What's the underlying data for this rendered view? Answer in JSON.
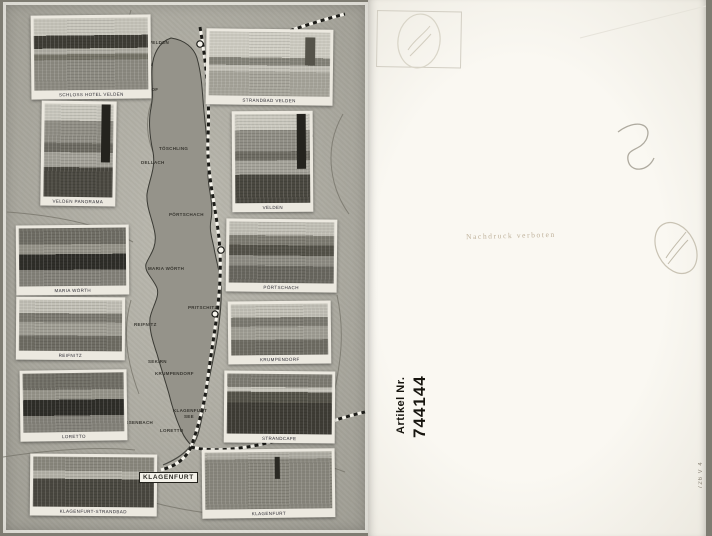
{
  "postcard": {
    "type": "scanned vintage postcard, front (Wörthersee pictorial map) and back",
    "colors": {
      "front_paper": "#b4b2a7",
      "lake_fill": "#95938a",
      "back_paper": "#f7f5ee",
      "artikel_text": "#17150f",
      "faint_stamp": "#c7c1b2"
    },
    "front": {
      "photos": [
        {
          "caption": "SCHLOSS HOTEL VELDEN",
          "variant": "v-hotel",
          "x": 28,
          "y": 13,
          "w": 120,
          "h": 84,
          "tilt": -0.6
        },
        {
          "caption": "VELDEN PANORAMA",
          "variant": "v-mtn",
          "x": 38,
          "y": 99,
          "w": 75,
          "h": 105,
          "tilt": 0.8
        },
        {
          "caption": "MARIA WÖRTH",
          "variant": "v-island",
          "x": 13,
          "y": 223,
          "w": 113,
          "h": 70,
          "tilt": -0.5
        },
        {
          "caption": "REIFNITZ",
          "variant": "v-village",
          "x": 13,
          "y": 295,
          "w": 109,
          "h": 63,
          "tilt": 0.4
        },
        {
          "caption": "LORETTO",
          "variant": "v-island",
          "x": 17,
          "y": 368,
          "w": 107,
          "h": 71,
          "tilt": -0.8
        },
        {
          "caption": "KLAGENFURT-STRANDBAD",
          "variant": "v-forest",
          "x": 27,
          "y": 452,
          "w": 127,
          "h": 62,
          "tilt": 0.5
        },
        {
          "caption": "STRANDBAD VELDEN",
          "variant": "v-beach",
          "x": 203,
          "y": 27,
          "w": 127,
          "h": 76,
          "tilt": 0.7
        },
        {
          "caption": "VELDEN",
          "variant": "v-mtn",
          "x": 229,
          "y": 109,
          "w": 81,
          "h": 101,
          "tilt": -0.4
        },
        {
          "caption": "PÖRTSCHACH",
          "variant": "v-pan",
          "x": 223,
          "y": 217,
          "w": 111,
          "h": 73,
          "tilt": 0.6
        },
        {
          "caption": "KRUMPENDORF",
          "variant": "v-village",
          "x": 225,
          "y": 299,
          "w": 103,
          "h": 63,
          "tilt": -0.6
        },
        {
          "caption": "STRANDCAFE",
          "variant": "v-darklake",
          "x": 221,
          "y": 369,
          "w": 111,
          "h": 72,
          "tilt": 0.5
        },
        {
          "caption": "KLAGENFURT",
          "variant": "v-town",
          "x": 199,
          "y": 447,
          "w": 133,
          "h": 69,
          "tilt": -0.7
        }
      ],
      "map_labels": [
        {
          "text": "VELDEN",
          "x": 146,
          "y": 38
        },
        {
          "text": "AUEN",
          "x": 136,
          "y": 60
        },
        {
          "text": "AUENHOF",
          "x": 131,
          "y": 85
        },
        {
          "text": "TÖSCHLING",
          "x": 156,
          "y": 144
        },
        {
          "text": "DELLACH",
          "x": 138,
          "y": 158
        },
        {
          "text": "PÖRTSCHACH",
          "x": 166,
          "y": 210
        },
        {
          "text": "ST. MARTIN",
          "x": 288,
          "y": 132,
          "tiny": true
        },
        {
          "text": "MARIA WÖRTH",
          "x": 145,
          "y": 264
        },
        {
          "text": "PRITSCHITZ",
          "x": 185,
          "y": 303
        },
        {
          "text": "REIFNITZ",
          "x": 131,
          "y": 320
        },
        {
          "text": "SEKIRN",
          "x": 145,
          "y": 357
        },
        {
          "text": "KRUMPENDORF",
          "x": 152,
          "y": 369
        },
        {
          "text": "WEISSENBACH",
          "x": 113,
          "y": 418
        },
        {
          "text": "KLAGENFURT",
          "x": 170,
          "y": 406
        },
        {
          "text": "SEE",
          "x": 181,
          "y": 412
        },
        {
          "text": "LORETTO",
          "x": 157,
          "y": 426
        },
        {
          "text": "KLAGENFURT",
          "x": 136,
          "y": 470,
          "boxed": true
        }
      ]
    },
    "back": {
      "nachdruck_text": "Nachdruck verboten",
      "artikel_label": "Artikel Nr.",
      "artikel_number": "744144",
      "edge_code": "726 V 4"
    }
  }
}
